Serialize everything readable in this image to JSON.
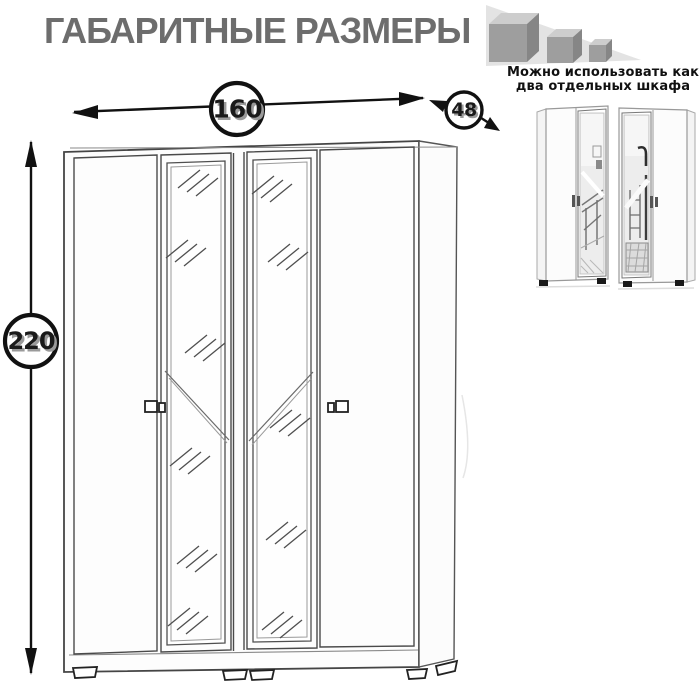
{
  "header": {
    "title": "ГАБАРИТНЫЕ РАЗМЕРЫ"
  },
  "usage_note": {
    "line1": "Можно использовать как",
    "line2": "два отдельных шкафа"
  },
  "dimensions": {
    "width": "160",
    "depth": "48",
    "height": "220"
  },
  "graphics": {
    "cubes_icon": "three-shrinking-cubes",
    "main_drawing": "four-door-wardrobe-with-two-mirror-doors",
    "photo_left": "two-door-wardrobe-mirror-on-right",
    "photo_right": "two-door-wardrobe-mirror-on-left"
  },
  "colors": {
    "title_gray": "#6d6d6d",
    "line_black": "#111111",
    "triangle_bg": "#e3e3e3",
    "cube_top": "#cdcdcd",
    "cube_front": "#9e9e9e",
    "cube_side": "#868686",
    "mirror_fill": "#ededed"
  }
}
